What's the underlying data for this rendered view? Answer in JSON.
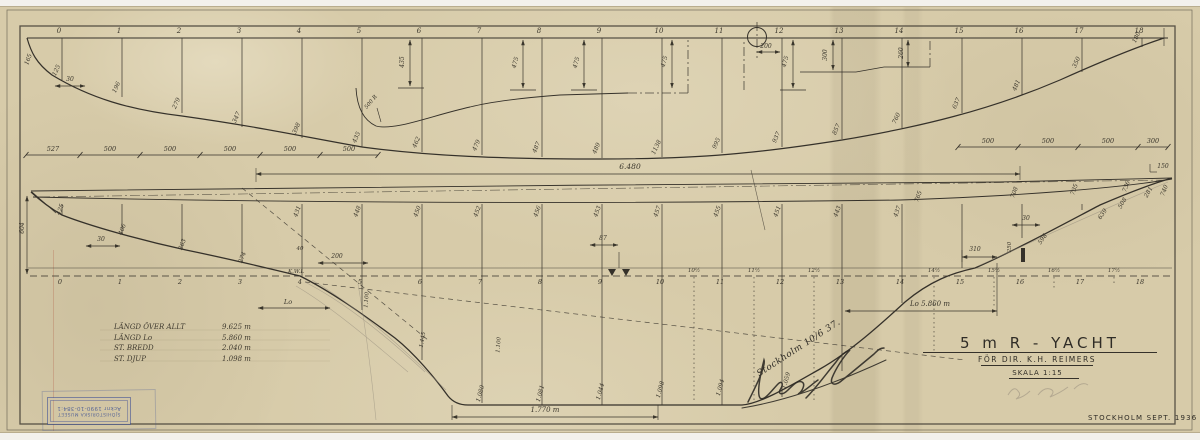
{
  "window": {
    "bg": "#f3f1ec",
    "paper": "#d7cba9",
    "ink": "#35312a",
    "pencil": "#8f8779",
    "stamp_blue": "#4052a0"
  },
  "title_block": {
    "title": "5 m R - YACHT",
    "client_line": "FÖR DIR. K.H. REIMERS",
    "scale_line": "SKALA 1:15",
    "place_date": "STOCKHOLM  SEPT. 1936"
  },
  "dimension_table": {
    "rows": [
      {
        "label": "LÄNGD ÖVER ALLT",
        "value": "9.625 m"
      },
      {
        "label": "LÄNGD Lo",
        "value": "5.860 m"
      },
      {
        "label": "ST. BREDD",
        "value": "2.040 m"
      },
      {
        "label": "ST. DJUP",
        "value": "1.098 m"
      }
    ]
  },
  "stamp": {
    "line1": "SJÖHISTORISKA MUSEET",
    "line2": "Acknr 1990-10-384:1"
  },
  "handwriting": {
    "note": "Stockholm 10/6 37."
  },
  "drawing": {
    "top_stations": [
      [
        62,
        "0",
        80,
        "125"
      ],
      [
        122,
        "1",
        97,
        "196"
      ],
      [
        182,
        "2",
        113,
        "279"
      ],
      [
        242,
        "3",
        127,
        "347"
      ],
      [
        302,
        "4",
        138,
        "398"
      ],
      [
        362,
        "5",
        147,
        "435"
      ],
      [
        422,
        "6",
        152,
        "462"
      ],
      [
        482,
        "7",
        155,
        "479"
      ],
      [
        542,
        "8",
        157,
        "487"
      ],
      [
        602,
        "9",
        158,
        "489"
      ],
      [
        662,
        "10",
        157,
        "1138"
      ],
      [
        722,
        "11",
        153,
        "995"
      ],
      [
        782,
        "12",
        147,
        "937"
      ],
      [
        842,
        "13",
        139,
        "857"
      ],
      [
        902,
        "14",
        128,
        "760"
      ],
      [
        962,
        "15",
        113,
        "637"
      ],
      [
        1022,
        "16",
        95,
        "481"
      ],
      [
        1082,
        "17",
        72,
        "350"
      ],
      [
        1142,
        "18",
        47,
        "180"
      ]
    ],
    "bot_stations": [
      [
        62,
        "0",
        215,
        ""
      ],
      [
        122,
        "1",
        234,
        ""
      ],
      [
        182,
        "2",
        249,
        ""
      ],
      [
        242,
        "3",
        262,
        ""
      ],
      [
        302,
        "4",
        277,
        "431"
      ],
      [
        362,
        "5",
        310,
        "448"
      ],
      [
        422,
        "6",
        360,
        "450"
      ],
      [
        482,
        "7",
        403,
        "452"
      ],
      [
        542,
        "8",
        405,
        "456"
      ],
      [
        602,
        "9",
        405,
        "453"
      ],
      [
        662,
        "10",
        405,
        "457"
      ],
      [
        722,
        "11",
        405,
        "455"
      ],
      [
        782,
        "12",
        397,
        "451"
      ],
      [
        842,
        "13",
        371,
        "443"
      ],
      [
        902,
        "14",
        303,
        "437"
      ],
      [
        962,
        "15",
        268,
        ""
      ],
      [
        1022,
        "16",
        238,
        ""
      ],
      [
        1082,
        "17",
        210,
        ""
      ],
      [
        1142,
        "18",
        204,
        ""
      ]
    ],
    "half_stations": [
      [
        694,
        "10½",
        403
      ],
      [
        754,
        "11½",
        403
      ],
      [
        814,
        "12½",
        400
      ],
      [
        934,
        "14½",
        352
      ],
      [
        994,
        "15½",
        308
      ],
      [
        1054,
        "16½",
        290
      ],
      [
        1114,
        "17½",
        285
      ]
    ],
    "chains": [
      {
        "y": 155,
        "ticks": [
          26,
          80,
          140,
          200,
          260,
          320,
          378
        ],
        "labels": [
          "527",
          "500",
          "500",
          "500",
          "500",
          "500"
        ]
      },
      {
        "y": 147,
        "ticks": [
          958,
          1018,
          1078,
          1138,
          1168
        ],
        "labels": [
          "500",
          "500",
          "500",
          "300"
        ]
      }
    ],
    "dims": [
      [
        256,
        174,
        1020,
        174
      ],
      [
        55,
        86,
        85,
        86
      ],
      [
        757,
        52,
        780,
        52
      ],
      [
        452,
        417,
        658,
        417
      ],
      [
        845,
        311,
        997,
        311
      ],
      [
        258,
        308,
        330,
        308
      ],
      [
        962,
        257,
        997,
        257
      ],
      [
        318,
        263,
        368,
        263
      ],
      [
        590,
        245,
        618,
        245
      ],
      [
        86,
        246,
        120,
        246
      ],
      [
        1012,
        225,
        1040,
        225
      ],
      [
        410,
        40,
        410,
        86
      ],
      [
        523,
        40,
        523,
        88
      ],
      [
        584,
        40,
        584,
        88
      ],
      [
        672,
        40,
        672,
        88
      ],
      [
        793,
        40,
        793,
        88
      ],
      [
        833,
        40,
        833,
        70
      ],
      [
        908,
        40,
        908,
        67
      ],
      [
        27,
        196,
        27,
        274
      ]
    ],
    "annotations": [
      [
        630,
        169,
        "6.480",
        0,
        7.5,
        "hand"
      ],
      [
        766,
        48,
        "200",
        0,
        6,
        "hand"
      ],
      [
        404,
        62,
        "435",
        -90,
        6,
        "hand"
      ],
      [
        372,
        103,
        "500 R",
        -50,
        5.5,
        "hand"
      ],
      [
        517,
        63,
        "475",
        -75,
        6,
        "hand"
      ],
      [
        578,
        63,
        "475",
        -75,
        6,
        "hand"
      ],
      [
        666,
        62,
        "475",
        -75,
        6,
        "hand"
      ],
      [
        787,
        62,
        "475",
        -75,
        6,
        "hand"
      ],
      [
        827,
        55,
        "300",
        -90,
        6,
        "hand"
      ],
      [
        903,
        53,
        "260",
        -90,
        6,
        "hand"
      ],
      [
        70,
        81,
        "30",
        0,
        6,
        "hand"
      ],
      [
        30,
        60,
        "165",
        -70,
        6,
        "hand"
      ],
      [
        296,
        273,
        "K.W.L",
        0,
        5.5,
        "hand"
      ],
      [
        288,
        304,
        "Lo",
        0,
        6.5,
        "hand"
      ],
      [
        930,
        306,
        "Lo 5.860 m",
        0,
        7,
        "hand"
      ],
      [
        545,
        412,
        "1.770 m",
        0,
        7,
        "hand"
      ],
      [
        337,
        258,
        "200",
        0,
        6,
        "hand"
      ],
      [
        300,
        250,
        "40",
        0,
        5.5,
        "hand"
      ],
      [
        603,
        240,
        "87",
        0,
        6,
        "hand"
      ],
      [
        101,
        241,
        "30",
        0,
        6,
        "hand"
      ],
      [
        1026,
        220,
        "30",
        0,
        6,
        "hand"
      ],
      [
        975,
        251,
        "310",
        0,
        6,
        "hand"
      ],
      [
        1011,
        247,
        "250",
        -90,
        5.5,
        "hand"
      ],
      [
        1163,
        168,
        "150",
        0,
        6,
        "hand"
      ],
      [
        24,
        228,
        "604",
        -90,
        6,
        "hand"
      ],
      [
        62,
        210,
        "425",
        -70,
        6,
        "hand"
      ],
      [
        124,
        230,
        "406",
        -70,
        6,
        "hand"
      ],
      [
        184,
        245,
        "363",
        -70,
        6,
        "hand"
      ],
      [
        244,
        258,
        "274",
        -70,
        6,
        "hand"
      ],
      [
        482,
        394,
        "1.080",
        -75,
        6,
        "hand"
      ],
      [
        542,
        394,
        "1.081",
        -75,
        6,
        "hand"
      ],
      [
        602,
        392,
        "1.044",
        -75,
        6,
        "hand"
      ],
      [
        662,
        390,
        "1.098",
        -75,
        6,
        "hand"
      ],
      [
        722,
        388,
        "1.094",
        -75,
        6,
        "hand"
      ],
      [
        788,
        381,
        "1.059",
        -75,
        6,
        "hand"
      ],
      [
        424,
        340,
        "1.445",
        -80,
        5.5,
        "hand"
      ],
      [
        500,
        345,
        "1.100",
        -85,
        5.5,
        "hand"
      ],
      [
        368,
        300,
        "1.100",
        -85,
        5.5,
        "hand"
      ],
      [
        920,
        197,
        "765",
        -70,
        6,
        "hand"
      ],
      [
        1016,
        193,
        "708",
        -70,
        6,
        "hand"
      ],
      [
        1076,
        190,
        "735",
        -70,
        6,
        "hand"
      ],
      [
        1128,
        187,
        "736",
        -70,
        6,
        "hand"
      ],
      [
        1150,
        193,
        "281",
        -60,
        6,
        "hand"
      ],
      [
        1166,
        191,
        "740",
        -70,
        6,
        "hand"
      ],
      [
        1104,
        215,
        "639",
        -55,
        6,
        "hand"
      ],
      [
        1044,
        240,
        "598",
        -55,
        6,
        "hand"
      ],
      [
        1124,
        204,
        "508",
        -60,
        6,
        "hand"
      ],
      [
        800,
        350,
        "Stockholm 10/6 37.",
        -33,
        9,
        "script"
      ]
    ]
  }
}
